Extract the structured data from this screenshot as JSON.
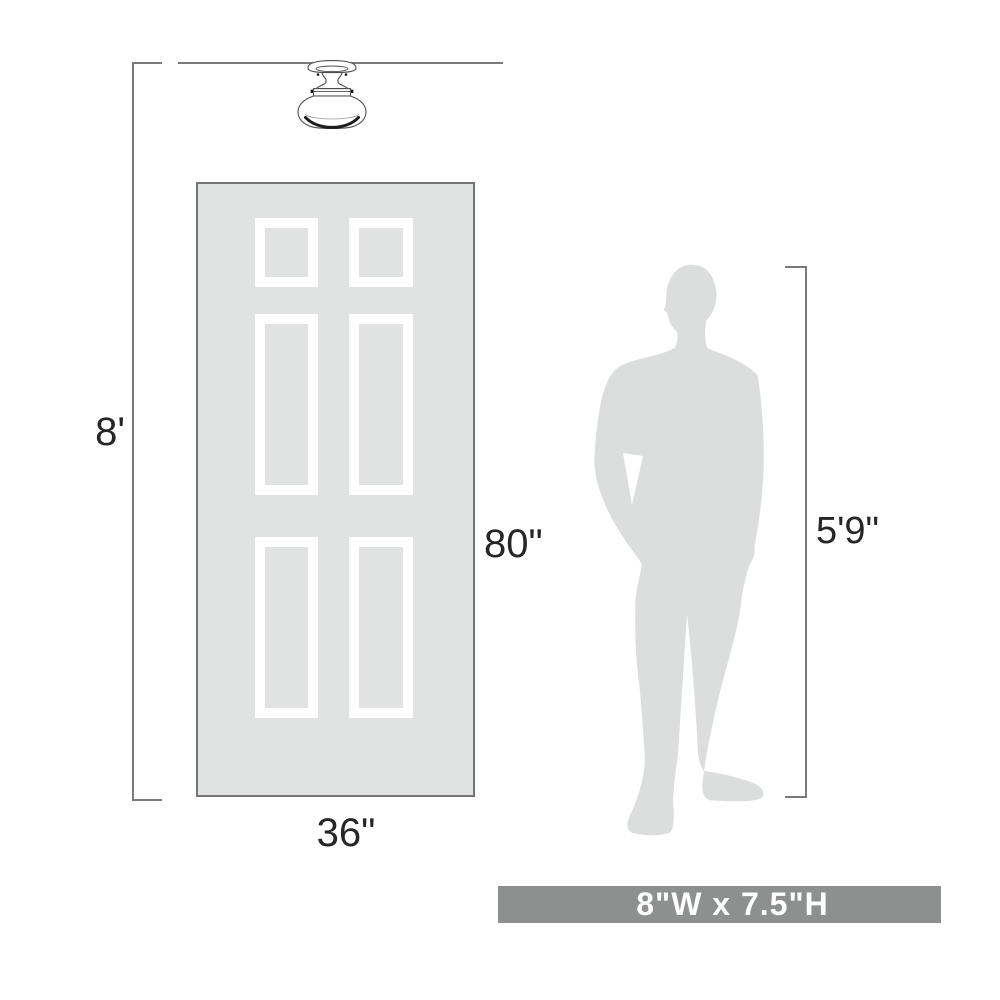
{
  "diagram": {
    "ceiling_height": "8'",
    "door": {
      "height": "80\"",
      "width": "36\""
    },
    "person_height": "5'9\"",
    "fixture_size": "8\"W x 7.5\"H"
  },
  "icons": {
    "light_fixture": "semi-flush-ceiling-light-icon",
    "person": "man-silhouette-icon",
    "door": "six-panel-door"
  },
  "colors": {
    "door_fill": "#e1e2e2",
    "door_border": "#747474",
    "panel_white": "#ffffff",
    "silhouette": "#dcdddd",
    "banner_bg": "#8e9090",
    "banner_text": "#ffffff",
    "line": "#7a7a7a",
    "ink": "#262626",
    "fixture_stroke": "#4f4f4f",
    "fixture_dark": "#1c1c1c"
  }
}
